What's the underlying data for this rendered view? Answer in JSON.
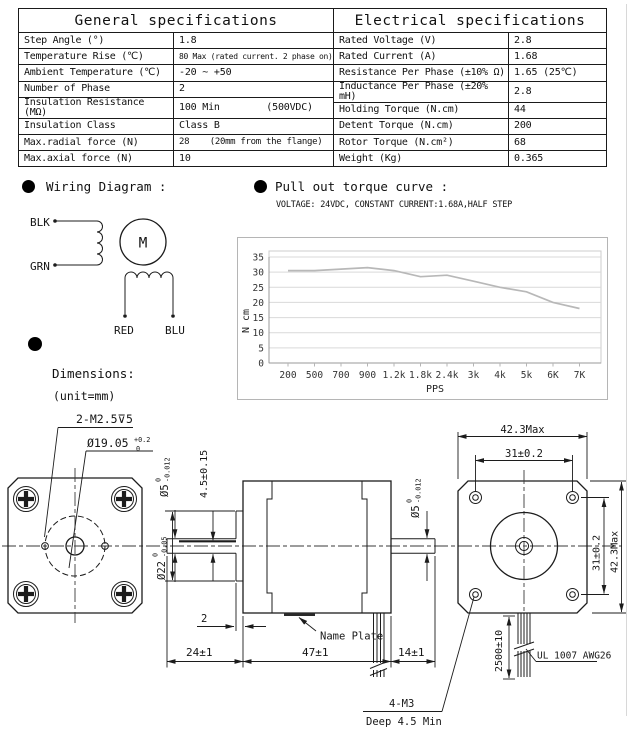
{
  "tables": {
    "general": {
      "title": "General specifications",
      "rows": [
        {
          "label": "Step Angle (°)",
          "value": "1.8"
        },
        {
          "label": "Temperature Rise (℃)",
          "value": "80 Max (rated current. 2 phase on)"
        },
        {
          "label": "Ambient Temperature (℃)",
          "value": "-20 ~ +50"
        },
        {
          "label": "Number of Phase",
          "value": "2"
        },
        {
          "label": "Insulation Resistance (MΩ)",
          "value": "100 Min        (500VDC)"
        },
        {
          "label": "Insulation Class",
          "value": "Class B"
        },
        {
          "label": "Max.radial force (N)",
          "value": "28    (20mm from the flange)"
        },
        {
          "label": "Max.axial force (N)",
          "value": "10"
        }
      ]
    },
    "electrical": {
      "title": "Electrical specifications",
      "rows": [
        {
          "label": "Rated Voltage (V)",
          "value": "2.8"
        },
        {
          "label": "Rated Current (A)",
          "value": "1.68"
        },
        {
          "label": "Resistance Per Phase (±10% Ω)",
          "value": "1.65 (25℃)"
        },
        {
          "label": "Inductance Per Phase (±20% mH)",
          "value": "2.8"
        },
        {
          "label": "Holding Torque (N.cm)",
          "value": "44"
        },
        {
          "label": "Detent Torque (N.cm)",
          "value": "200"
        },
        {
          "label": "Rotor Torque (N.cm²)",
          "value": "68"
        },
        {
          "label": "Weight (Kg)",
          "value": "0.365"
        }
      ]
    }
  },
  "wiring": {
    "heading": "Wiring Diagram :",
    "labels": {
      "blk": "BLK",
      "grn": "GRN",
      "red": "RED",
      "blu": "BLU",
      "motor": "M"
    }
  },
  "torque": {
    "heading": "Pull out torque curve :",
    "subtitle": "VOLTAGE: 24VDC, CONSTANT CURRENT:1.68A,HALF STEP"
  },
  "chart_data": {
    "type": "line",
    "title": "Pull out torque curve",
    "conditions": "VOLTAGE: 24VDC, CONSTANT CURRENT:1.68A, HALF STEP",
    "categories": [
      "200",
      "500",
      "700",
      "900",
      "1.2k",
      "1.8k",
      "2.4k",
      "3k",
      "4k",
      "5k",
      "6K",
      "7K"
    ],
    "values": [
      30.5,
      30.5,
      31,
      31.5,
      30.5,
      28.5,
      29,
      27,
      25,
      23.5,
      20,
      18
    ],
    "xlabel": "PPS",
    "ylabel": "N cm",
    "yticks": [
      0,
      5,
      10,
      15,
      20,
      25,
      30,
      35
    ],
    "ylim": [
      0,
      35
    ],
    "grid": true,
    "legend": false,
    "line_color": "#b8b8b8"
  },
  "dims": {
    "heading": "Dimensions:",
    "unit": "(unit=mm)",
    "screw_tap": "2-M2.5⊽5",
    "pilot": {
      "d": "Ø19.05",
      "sup": "+0.2",
      "sub": "0"
    },
    "shaft_front": {
      "d": "Ø5",
      "sup": "0",
      "sub": "-0.012"
    },
    "shaft_rear": {
      "d": "Ø5",
      "sup": "0",
      "sub": "-0.012"
    },
    "boss": {
      "d": "Ø22",
      "sup": "0",
      "sub": "-0.05"
    },
    "flat_height": "4.5±0.15",
    "boss_thickness": "2",
    "front_shaft_len": "24±1",
    "body_len": "47±1",
    "rear_shaft_len": "14±1",
    "name_plate": "Name Plate",
    "rear_tap": "4-M3",
    "rear_tap_depth": "Deep 4.5 Min",
    "frame_width": "42.3Max",
    "hole_pitch_h": "31±0.2",
    "hole_pitch_v": "31±0.2",
    "frame_height": "42.3Max",
    "lead_length": "2500±10",
    "lead_spec": "UL 1007 AWG26"
  }
}
